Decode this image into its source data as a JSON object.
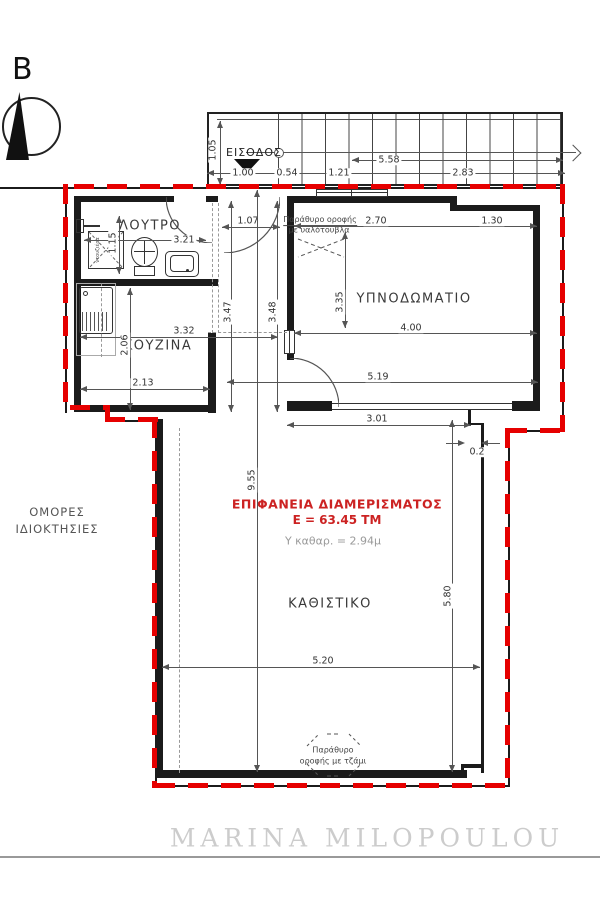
{
  "colors": {
    "boundary_red": "#e60000",
    "wall_black": "#1b1b1b",
    "red_text": "#cc2222",
    "muted_gray": "#9a9a9a"
  },
  "compass": {
    "north_label": "B"
  },
  "rooms": {
    "bathroom": {
      "label": "ΛΟΥΤΡΟ"
    },
    "kitchen": {
      "label": "ΚΟΥΖΙΝΑ"
    },
    "bedroom": {
      "label": "ΥΠΝΟΔΩΜΑΤΙΟ"
    },
    "living": {
      "label": "ΚΑΘΙΣΤΙΚΟ"
    },
    "entrance": {
      "label": "ΕΙΣΟΔΟΣ"
    },
    "neighbors": {
      "line1": "ΟΜΟΡΕΣ",
      "line2": "ΙΔΙΟΚΤΗΣΙΕΣ"
    }
  },
  "area_note": {
    "line1": "ΕΠΙΦΑΝΕΙΑ ΔΙΑΜΕΡΙΣΜΑΤΟΣ",
    "line2": "Ε = 63.45 ΤΜ",
    "height_note": "Υ καθαρ. = 2.94μ"
  },
  "annotations": {
    "skylight_top_1": "Παράθυρο οροφής",
    "skylight_top_2": "με υαλότουβλα",
    "skylight_bottom_1": "Παράθυρο",
    "skylight_bottom_2": "οροφής με τζάμι",
    "shower": "ντουζιέρα"
  },
  "dims": {
    "d105": "1.05",
    "d100": "1.00",
    "d054": "0.54",
    "d121": "1.21",
    "d558": "5.58",
    "d283": "2.83",
    "d115": "1.15",
    "d321": "3.21",
    "d107": "1.07",
    "d332": "3.32",
    "d206": "2.06",
    "d213": "2.13",
    "d347": "3.47",
    "d348": "3.48",
    "d270": "2.70",
    "d130": "1.30",
    "d335": "3.35",
    "d400": "4.00",
    "d519": "5.19",
    "d301": "3.01",
    "d02": "0.2",
    "d955": "9.55",
    "d520": "5.20",
    "d580": "5.80"
  },
  "watermark": "MARINA MILOPOULOU"
}
